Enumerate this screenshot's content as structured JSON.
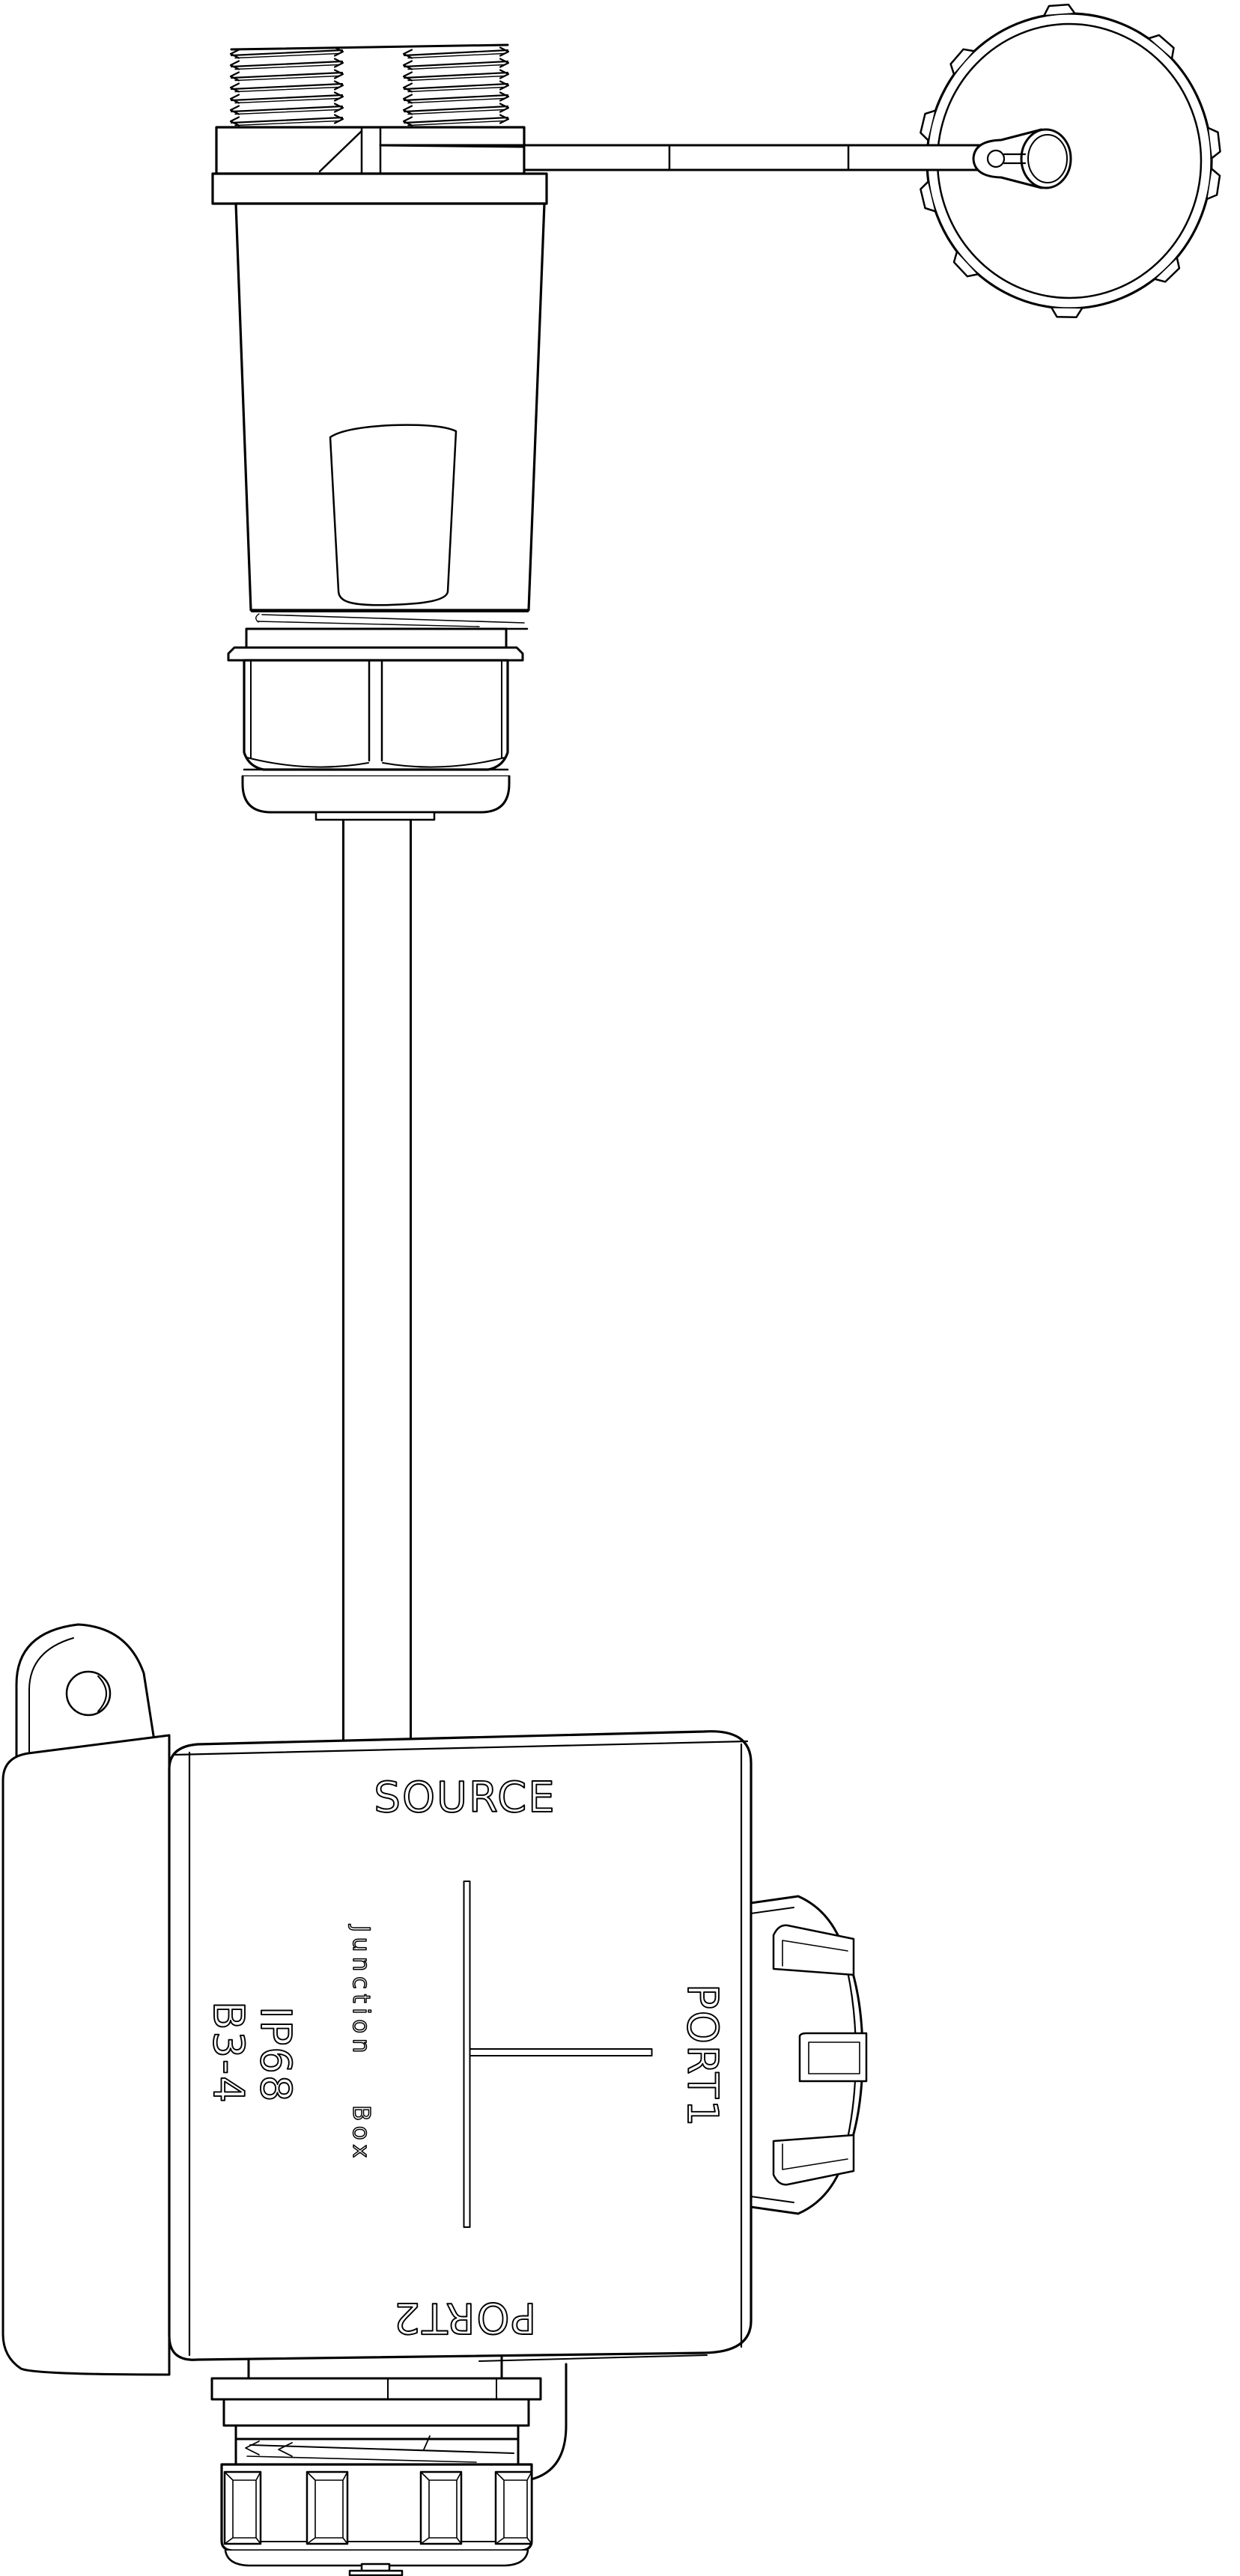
{
  "drawing": {
    "background": "#ffffff",
    "line_color": "#000000",
    "labels": {
      "source": "SOURCE",
      "junction_word1": "Junction",
      "junction_word2": "Box",
      "ip_rating": "IP68",
      "model": "B3-4",
      "port1": "PORT1",
      "port2": "PORT2"
    }
  }
}
